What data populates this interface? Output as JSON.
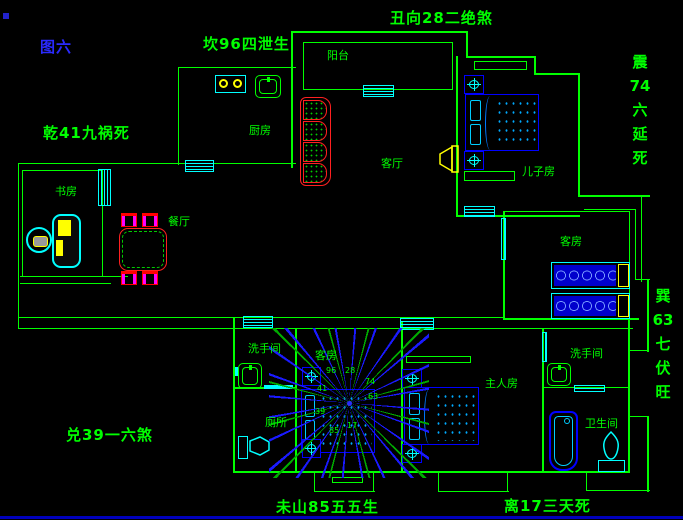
{
  "figure_label": "图六",
  "annotations": {
    "kan": "坎96四泄生",
    "chou": "丑向28二绝煞",
    "qian": "乾41九祸死",
    "dui": "兑39一六煞",
    "wei": "未山85五五生",
    "li": "离17三天死",
    "zhen": [
      "震",
      "74",
      "六",
      "延",
      "死"
    ],
    "xun": [
      "巽",
      "63",
      "七",
      "伏",
      "旺"
    ]
  },
  "rooms": {
    "kitchen": "厨房",
    "balcony": "阳台",
    "living_room": "客厅",
    "study": "书房",
    "dining": "餐厅",
    "son_bedroom": "儿子房",
    "guest_bedroom": "客房",
    "center_bedroom": "客房",
    "washroom_left": "洗手间",
    "toilet": "厕所",
    "master_bedroom": "主人房",
    "washroom_right": "洗手间",
    "bathroom": "卫生间"
  },
  "compass_numbers": [
    "96",
    "28",
    "74",
    "63",
    "17",
    "85",
    "39",
    "41"
  ],
  "colors": {
    "wall": "#00ff00",
    "fixture": "#00ffff",
    "furniture": "#0000ff",
    "accent": "#ffff00",
    "sofa_red": "#ff2020",
    "chair_magenta": "#ff00ff",
    "label_green": "#00ff00",
    "figure_blue": "#2a2aff"
  }
}
